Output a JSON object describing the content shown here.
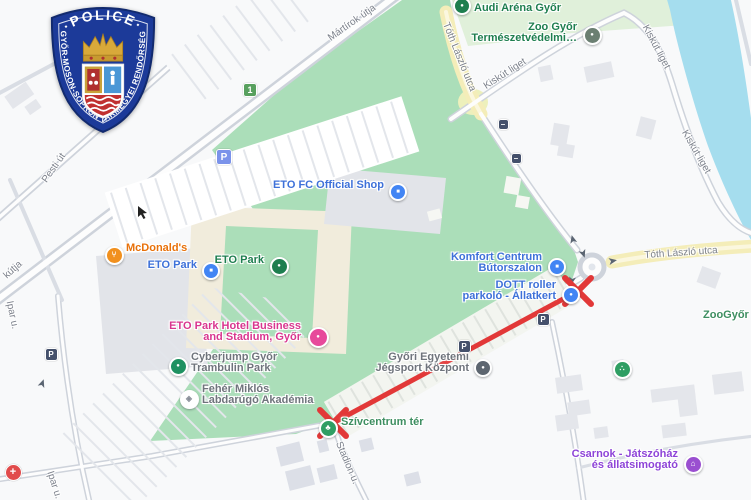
{
  "badge": {
    "top_text": "·POLICE·",
    "ring_text": "GYŐR-MOSON-SOPRON VÁRMEGYEI RENDŐRSÉG"
  },
  "map": {
    "attribution": "Google-style street map of Győr, ETO Park area",
    "route_closure": {
      "description": "red line with X marks between Szívcentrum tér and the DOTT roller parkoló roundabout",
      "color": "#e23838",
      "from": {
        "x": 333,
        "y": 423
      },
      "to": {
        "x": 578,
        "y": 291
      },
      "x_size": 13
    },
    "colors": {
      "park_green": "#abdeb9",
      "pale_green": "#e0f0da",
      "water": "#a5ddee",
      "road_yellow": "#f4edb9",
      "building_gray": "#e4e6eb",
      "building_cream": "#f1ecdc",
      "poi_blue": "#3e71d9",
      "poi_green": "#1e7e4f",
      "poi_gray": "#6f747c",
      "poi_orange": "#e8710a",
      "poi_pink": "#d9368f",
      "poi_purple": "#8e44d8",
      "park_label_green": "#3d8e60"
    },
    "pois": [
      {
        "id": "audi-arena",
        "label": [
          "Audi Aréna Győr"
        ],
        "align": "start",
        "tx": 474,
        "ty": 8,
        "color": "#1e7e4f",
        "marker": {
          "x": 460,
          "y": 4,
          "bg": "#1e7e4f",
          "size": 14,
          "tail": true,
          "glyph": "●"
        }
      },
      {
        "id": "zoo-gyor",
        "label": [
          "Zoo Győr",
          "Természetvédelmi…"
        ],
        "align": "end",
        "tx": 577,
        "ty": 27,
        "color": "#1e7e4f",
        "marker": {
          "x": 590,
          "y": 33,
          "bg": "#6b7f72",
          "size": 15,
          "tail": true,
          "glyph": "●"
        }
      },
      {
        "id": "eto-fc-official-shop",
        "label": [
          "ETO FC Official Shop"
        ],
        "align": "end",
        "tx": 384,
        "ty": 185,
        "color": "#3e71d9",
        "marker": {
          "x": 396,
          "y": 190,
          "bg": "#4285f4",
          "size": 14,
          "tail": true,
          "glyph": "■"
        }
      },
      {
        "id": "mcdonalds",
        "label": [
          "McDonald's"
        ],
        "align": "start",
        "tx": 126,
        "ty": 248,
        "color": "#e8710a",
        "marker": {
          "x": 112,
          "y": 253,
          "bg": "#f1901e",
          "size": 15,
          "tail": true,
          "glyph": "⑂"
        }
      },
      {
        "id": "eto-park-mall",
        "label": [
          "ETO Park"
        ],
        "align": "end",
        "tx": 197,
        "ty": 265,
        "color": "#3e71d9",
        "marker": {
          "x": 209,
          "y": 269,
          "bg": "#4285f4",
          "size": 14,
          "tail": true,
          "glyph": "■"
        }
      },
      {
        "id": "eto-park-green",
        "label": [
          "ETO Park"
        ],
        "align": "end",
        "tx": 264,
        "ty": 260,
        "color": "#1e7e4f",
        "marker": {
          "x": 277,
          "y": 264,
          "bg": "#1e7e4f",
          "size": 15,
          "tail": true,
          "glyph": "●"
        }
      },
      {
        "id": "komfort-centrum",
        "label": [
          "Komfort Centrum",
          "Bútorszalon"
        ],
        "align": "end",
        "tx": 542,
        "ty": 257,
        "color": "#3e71d9",
        "marker": {
          "x": 555,
          "y": 265,
          "bg": "#4285f4",
          "size": 14,
          "tail": true,
          "glyph": "■"
        }
      },
      {
        "id": "dott-roller",
        "label": [
          "DOTT roller",
          "parkoló - Állatkert"
        ],
        "align": "end",
        "tx": 556,
        "ty": 285,
        "color": "#3e71d9",
        "marker": {
          "x": 569,
          "y": 293,
          "bg": "#4285f4",
          "size": 14,
          "tail": false,
          "glyph": "●"
        }
      },
      {
        "id": "eto-park-hotel",
        "label": [
          "ETO Park Hotel Business",
          "and Stadium, Győr"
        ],
        "align": "end",
        "tx": 301,
        "ty": 326,
        "color": "#d9368f",
        "marker": {
          "x": 316,
          "y": 335,
          "bg": "#e7499b",
          "size": 17,
          "tail": false,
          "glyph": "●"
        }
      },
      {
        "id": "cyberjump",
        "label": [
          "Cyberjump Győr",
          "Trambulin Park"
        ],
        "align": "start",
        "tx": 191,
        "ty": 357,
        "color": "#6f747c",
        "marker": {
          "x": 176,
          "y": 364,
          "bg": "#1f9161",
          "size": 15,
          "tail": true,
          "glyph": "●"
        }
      },
      {
        "id": "feher-miklos-akademia",
        "label": [
          "Fehér Miklós",
          "Labdarúgó Akadémia"
        ],
        "align": "start",
        "tx": 202,
        "ty": 389,
        "color": "#6f747c",
        "marker": {
          "x": 187,
          "y": 397,
          "bg": "#ffffff",
          "size": 15,
          "tail": true,
          "glyph": "◈",
          "glyph_color": "#8a8f99"
        }
      },
      {
        "id": "jegsport-kozpont",
        "label": [
          "Győri Egyetemi",
          "Jégsport Központ"
        ],
        "align": "end",
        "tx": 469,
        "ty": 357,
        "color": "#6f747c",
        "marker": {
          "x": 481,
          "y": 366,
          "bg": "#5d6670",
          "size": 14,
          "tail": true,
          "glyph": "●"
        }
      },
      {
        "id": "szivcentrum-ter",
        "label": [
          "Szívcentrum tér"
        ],
        "align": "start",
        "tx": 341,
        "ty": 422,
        "color": "#3d8e60",
        "marker": {
          "x": 326,
          "y": 426,
          "bg": "#2f9e63",
          "size": 15,
          "tail": true,
          "glyph": "♣"
        }
      },
      {
        "id": "paw-zoo-poi",
        "label": [],
        "align": "start",
        "tx": 620,
        "ty": 367,
        "color": "#1e7e4f",
        "marker": {
          "x": 620,
          "y": 367,
          "bg": "#2f9e63",
          "size": 15,
          "tail": true,
          "glyph": "∴"
        }
      },
      {
        "id": "csarnok-jatszohaz",
        "label": [
          "Csarnok - Játszóház",
          "és állatsimogató"
        ],
        "align": "end",
        "tx": 678,
        "ty": 454,
        "color": "#8e44d8",
        "marker": {
          "x": 691,
          "y": 462,
          "bg": "#9a4fd0",
          "size": 15,
          "tail": true,
          "glyph": "⌂"
        }
      },
      {
        "id": "zoogyor-area",
        "label": [
          "ZooGyőr"
        ],
        "align": "start",
        "tx": 703,
        "ty": 315,
        "color": "#3d8e60",
        "marker": null
      }
    ],
    "road_labels": [
      {
        "id": "martirok-utja",
        "text": "Mártírok útja",
        "x": 352,
        "y": 23,
        "rot": -35
      },
      {
        "id": "pesti-ut",
        "text": "Pesti út",
        "x": 54,
        "y": 168,
        "rot": -55
      },
      {
        "id": "kutja-partial",
        "text": "kútja",
        "x": 13,
        "y": 270,
        "rot": -42
      },
      {
        "id": "ipar-u-1",
        "text": "Ipar u.",
        "x": 12,
        "y": 315,
        "rot": 78
      },
      {
        "id": "ipar-u-2",
        "text": "Ipar u.",
        "x": 54,
        "y": 485,
        "rot": 72
      },
      {
        "id": "stadion-u",
        "text": "Stadion u.",
        "x": 347,
        "y": 463,
        "rot": 67
      },
      {
        "id": "toth-laszlo-utca-1",
        "text": "Tóth László utca",
        "x": 459,
        "y": 57,
        "rot": 68
      },
      {
        "id": "toth-laszlo-utca-2",
        "text": "Tóth László utca",
        "x": 681,
        "y": 253,
        "rot": -4
      },
      {
        "id": "kiskut-liget-1",
        "text": "Kiskút liget",
        "x": 505,
        "y": 74,
        "rot": -33
      },
      {
        "id": "kiskut-liget-2",
        "text": "Kiskút liget",
        "x": 656,
        "y": 47,
        "rot": 62
      },
      {
        "id": "kiskut-liget-3",
        "text": "Kiskút liget",
        "x": 696,
        "y": 152,
        "rot": 60
      }
    ],
    "small_icons": [
      {
        "id": "parking-lot-icon",
        "x": 223,
        "y": 156,
        "size": 14,
        "bg": "#7b93ea",
        "glyph": "P",
        "fs": 10
      },
      {
        "id": "route-shield-1",
        "x": 249,
        "y": 89,
        "size": 12,
        "bg": "#58a05e",
        "glyph": "1",
        "fs": 9
      },
      {
        "id": "parking-dark-1",
        "x": 542,
        "y": 318,
        "size": 11,
        "bg": "#44506b",
        "glyph": "P",
        "fs": 8
      },
      {
        "id": "parking-dark-2",
        "x": 463,
        "y": 345,
        "size": 11,
        "bg": "#44506b",
        "glyph": "P",
        "fs": 8
      },
      {
        "id": "parking-dark-3",
        "x": 50,
        "y": 353,
        "size": 11,
        "bg": "#44506b",
        "glyph": "P",
        "fs": 8
      },
      {
        "id": "gate-1",
        "x": 502,
        "y": 123,
        "size": 9,
        "bg": "#44506b",
        "glyph": "–",
        "fs": 8
      },
      {
        "id": "gate-2",
        "x": 515,
        "y": 157,
        "size": 9,
        "bg": "#44506b",
        "glyph": "–",
        "fs": 8
      },
      {
        "id": "medical-poi",
        "x": 12,
        "y": 471,
        "size": 15,
        "bg": "#e14b4b",
        "glyph": "+",
        "fs": 11,
        "round": true
      }
    ]
  }
}
